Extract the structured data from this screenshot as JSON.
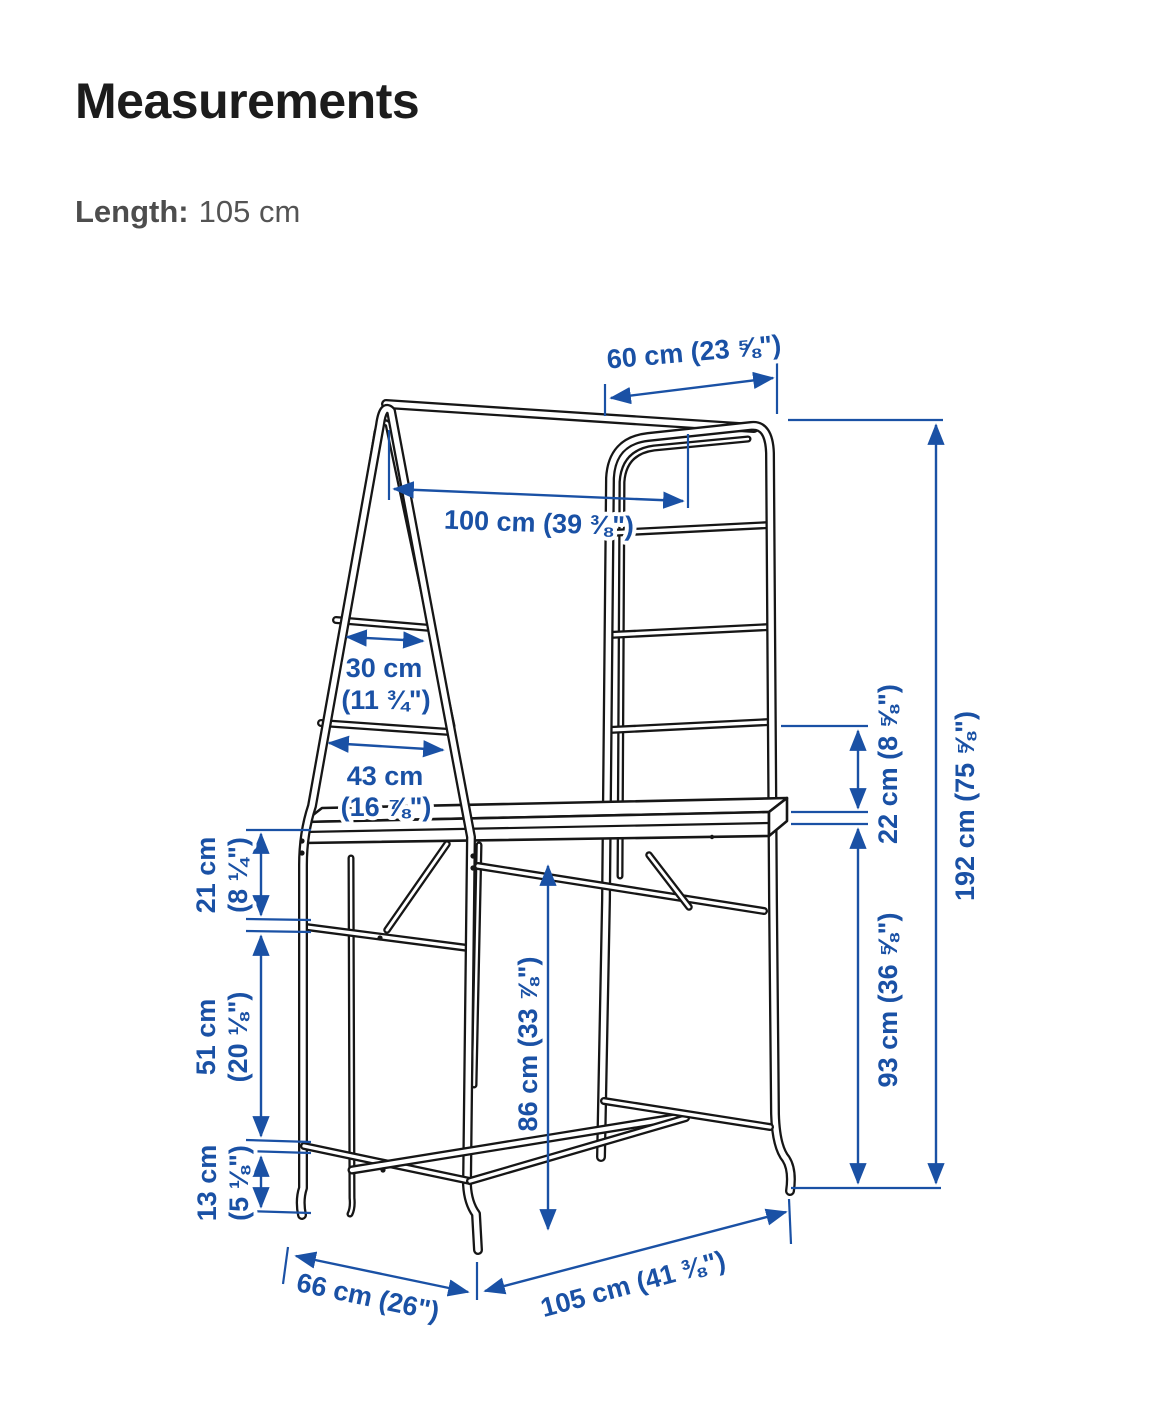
{
  "header": {
    "title": "Measurements"
  },
  "spec": {
    "label": "Length:",
    "value": "105 cm"
  },
  "colors": {
    "dimension_blue": "#1a51a5",
    "drawing_black": "#161616"
  },
  "dims": {
    "top_width": "60 cm (23 ⅝\")",
    "rail_length": "100 cm (39 ⅜\")",
    "ladder_upper_l1": "30 cm",
    "ladder_upper_l2": "(11 ¾\")",
    "ladder_lower_l1": "43 cm",
    "ladder_lower_l2": "(16 ⅞\")",
    "left_top_l1": "21 cm",
    "left_top_l2": "(8 ¼\")",
    "left_mid_l1": "51 cm",
    "left_mid_l2": "(20 ⅛\")",
    "left_bot_l1": "13 cm",
    "left_bot_l2": "(5 ⅛\")",
    "table_height": "86 cm (33 ⅞\")",
    "right_gap": "22 cm (8 ⅝\")",
    "right_lower": "93 cm (36 ⅝\")",
    "total_height": "192 cm (75 ⅝\")",
    "depth": "66 cm (26\")",
    "length": "105 cm (41 ⅜\")"
  }
}
